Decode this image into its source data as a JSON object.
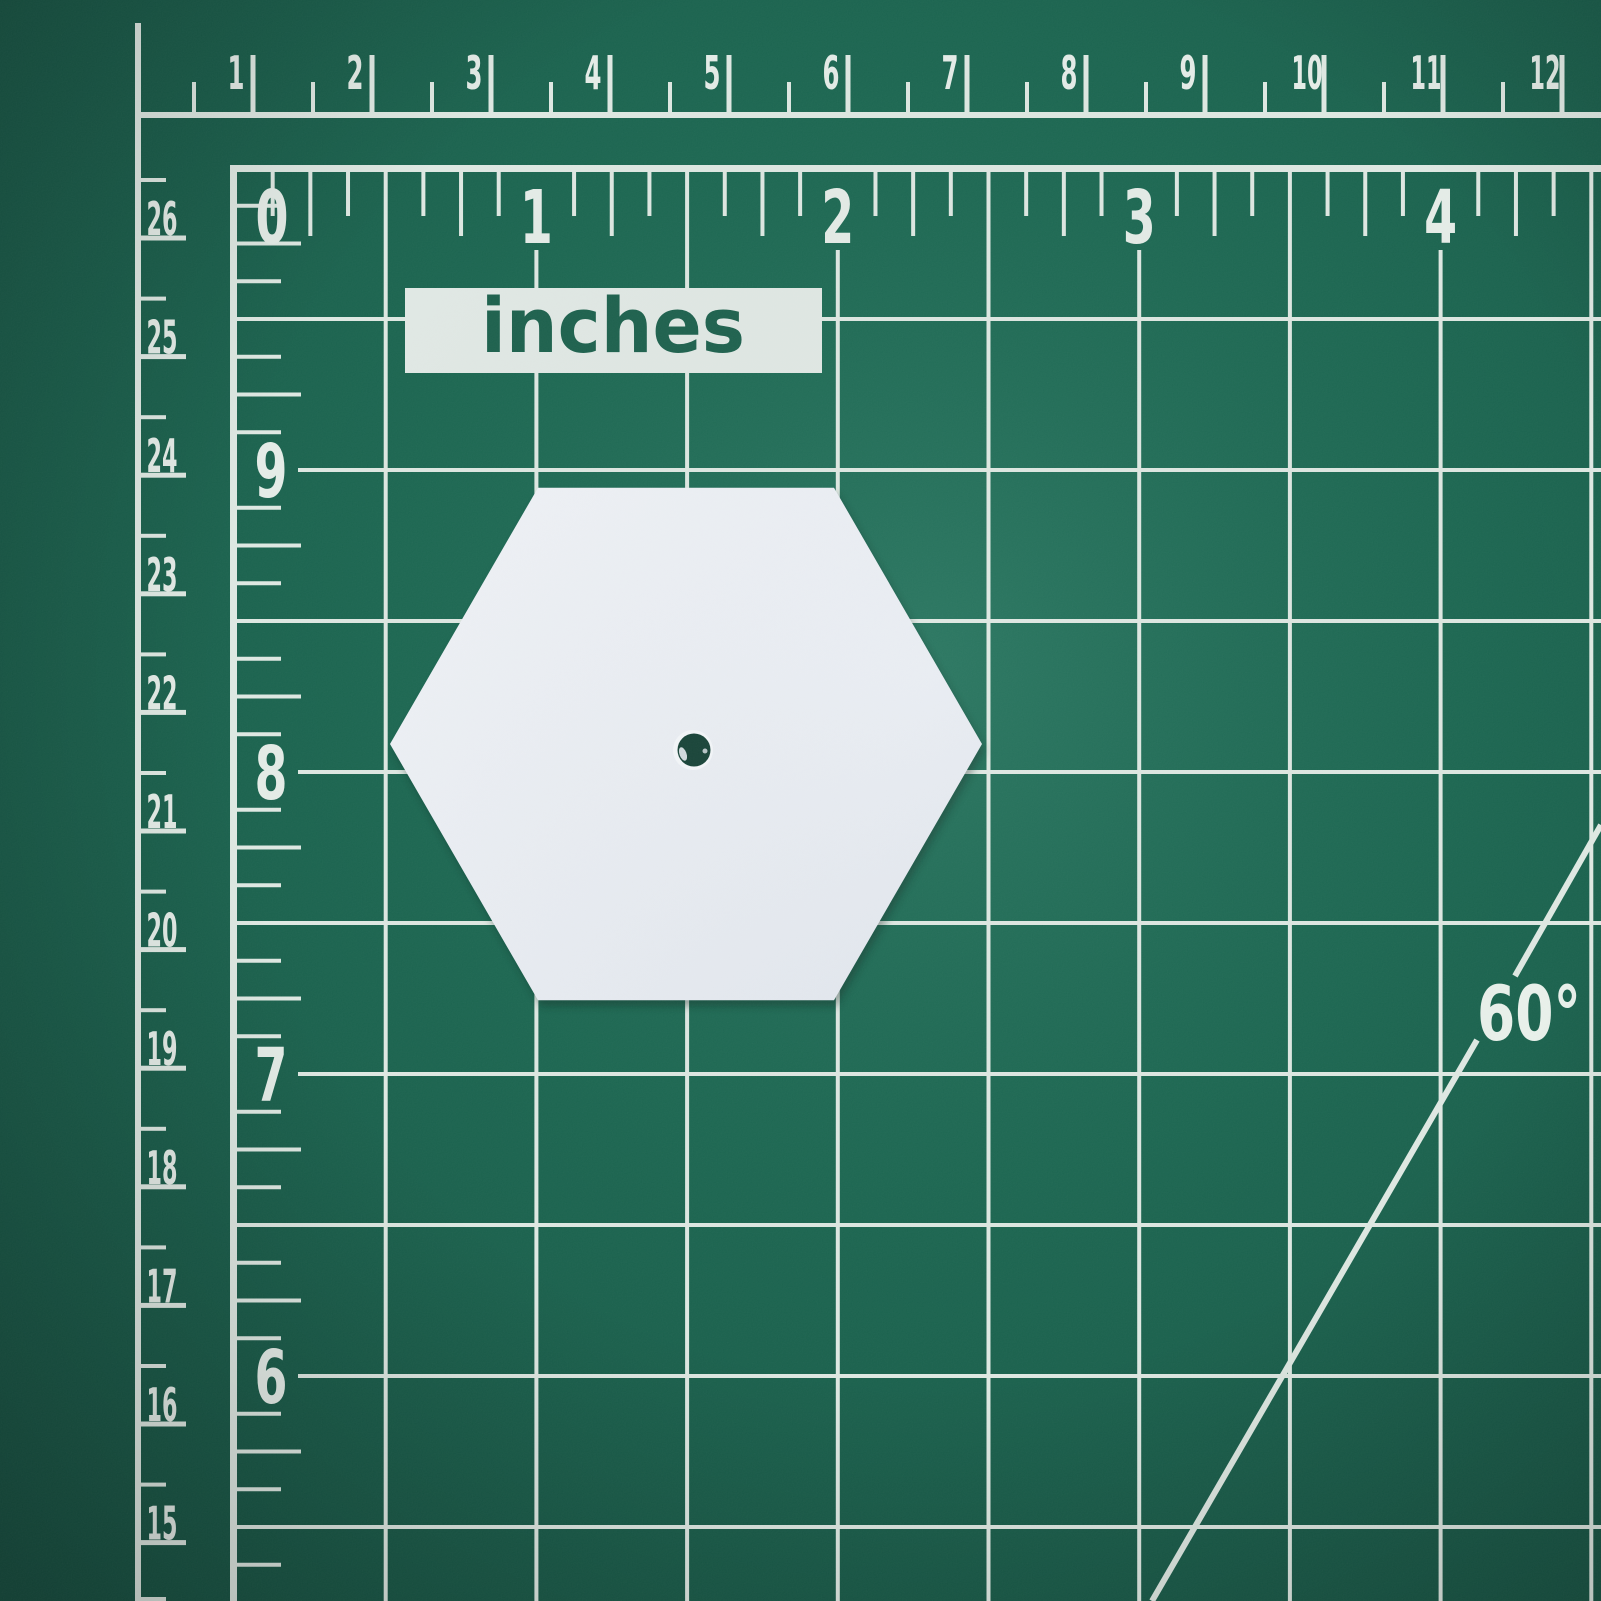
{
  "mat": {
    "unit_label": "inches",
    "angle_label": "60°",
    "top_ruler_labels": [
      "1",
      "2",
      "3",
      "4",
      "5",
      "6",
      "7",
      "8",
      "9",
      "10",
      "11",
      "12"
    ],
    "left_ruler_labels": [
      "26",
      "25",
      "24",
      "23",
      "22",
      "21",
      "20",
      "19",
      "18",
      "17",
      "16",
      "15"
    ],
    "grid_column_labels": [
      "0",
      "1",
      "2",
      "3",
      "4"
    ],
    "grid_row_labels": [
      "9",
      "8",
      "7",
      "6"
    ],
    "colors": {
      "mat_green": "#186350",
      "marking_white": "#dde7e1",
      "hexagon_white": "#e9edf3",
      "hole_green": "#123f33"
    }
  }
}
